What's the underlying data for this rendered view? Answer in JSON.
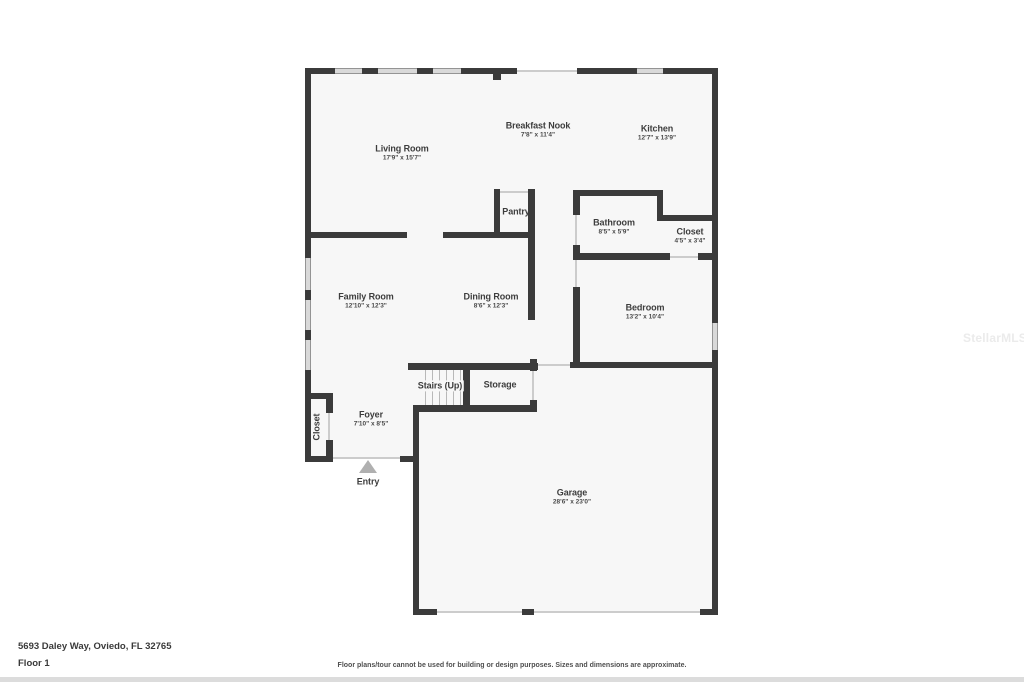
{
  "floorplan": {
    "rooms": {
      "living_room": {
        "name": "Living Room",
        "dims": "17'9\" x 15'7\""
      },
      "breakfast_nook": {
        "name": "Breakfast Nook",
        "dims": "7'8\" x 11'4\""
      },
      "kitchen": {
        "name": "Kitchen",
        "dims": "12'7\" x 13'9\""
      },
      "pantry": {
        "name": "Pantry"
      },
      "bathroom": {
        "name": "Bathroom",
        "dims": "8'5\" x 5'9\""
      },
      "closet_bath": {
        "name": "Closet",
        "dims": "4'5\" x 3'4\""
      },
      "family_room": {
        "name": "Family Room",
        "dims": "12'10\" x 12'3\""
      },
      "dining_room": {
        "name": "Dining Room",
        "dims": "8'6\" x 12'3\""
      },
      "bedroom": {
        "name": "Bedroom",
        "dims": "13'2\" x 10'4\""
      },
      "stairs": {
        "name": "Stairs (Up)"
      },
      "storage": {
        "name": "Storage"
      },
      "foyer": {
        "name": "Foyer",
        "dims": "7'10\" x 8'5\""
      },
      "closet_foyer": {
        "name": "Closet"
      },
      "entry": {
        "name": "Entry"
      },
      "garage": {
        "name": "Garage",
        "dims": "28'6\" x 23'0\""
      }
    }
  },
  "footer": {
    "address": "5693 Daley Way, Oviedo, FL 32765",
    "floor_label": "Floor 1",
    "disclaimer": "Floor plans/tour cannot be used for building or design purposes. Sizes and dimensions are approximate."
  },
  "watermark": "StellarMLS",
  "colors": {
    "wall": "#3b3b3b",
    "floor_fill": "#f7f7f7",
    "window_fill": "#d9d9d9",
    "entry_arrow": "#b0b0b0",
    "label_text": "#3d3d3d"
  }
}
